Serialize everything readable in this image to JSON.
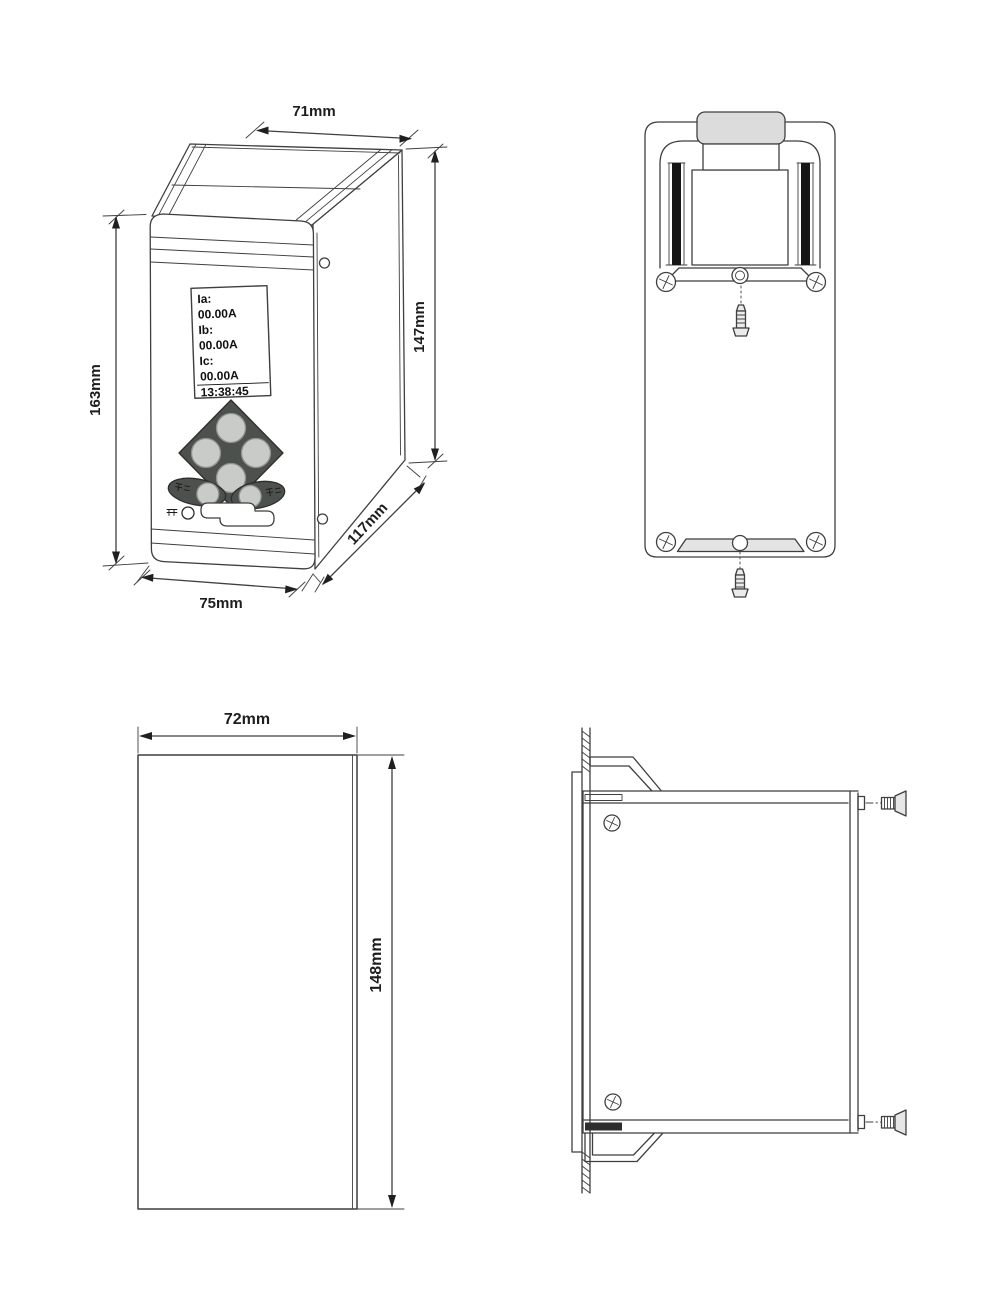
{
  "figure": {
    "type": "technical-dimension-drawing",
    "line_color": "#3f3f3f",
    "views": {
      "perspective": {
        "dims": {
          "top_width": "71mm",
          "right_height": "147mm",
          "left_height": "163mm",
          "bottom_width": "75mm",
          "depth": "117mm"
        },
        "lcd": {
          "lines": [
            "Ia:",
            "00.00A",
            "Ib:",
            "00.00A",
            "Ic:",
            "00.00A",
            "13:38:45"
          ]
        }
      },
      "front_outline": {
        "dims": {
          "width": "72mm",
          "height": "148mm"
        }
      }
    }
  }
}
